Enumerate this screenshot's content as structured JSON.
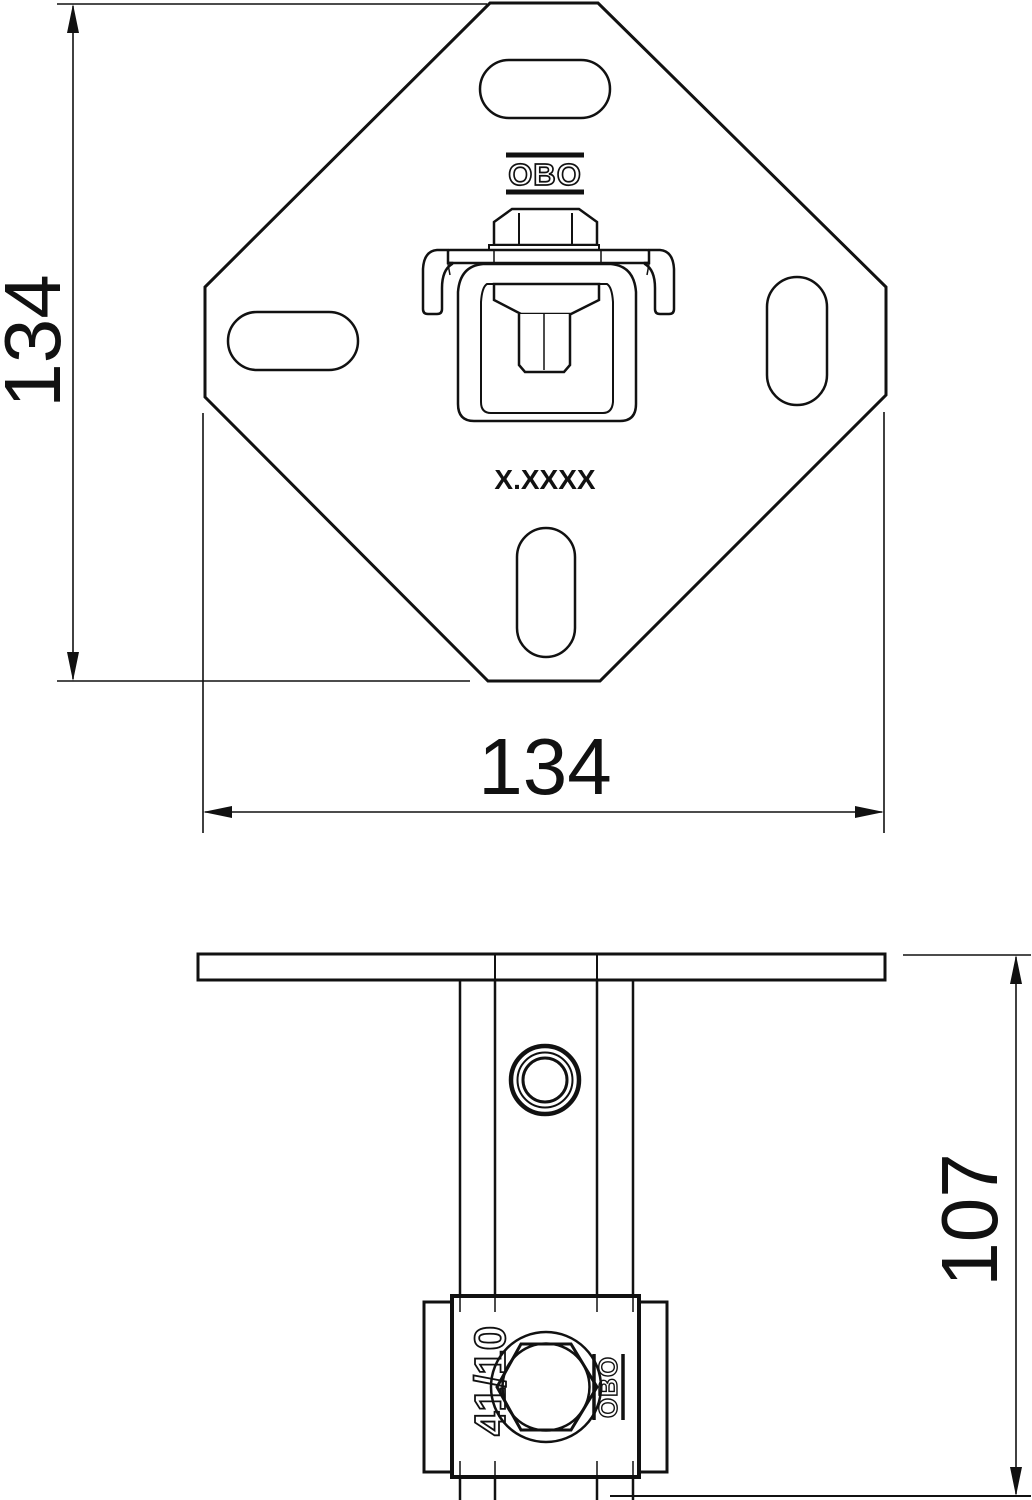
{
  "meta": {
    "drawing_type": "technical-drawing",
    "background_color": "#ffffff",
    "line_color": "#111111"
  },
  "top_view": {
    "brand_logo": "OBO",
    "part_marking": "X.XXXX",
    "dim_height": "134",
    "dim_width": "134"
  },
  "side_view": {
    "clamp_marking": "41/10",
    "brand_logo": "OBO",
    "dim_height": "107"
  }
}
